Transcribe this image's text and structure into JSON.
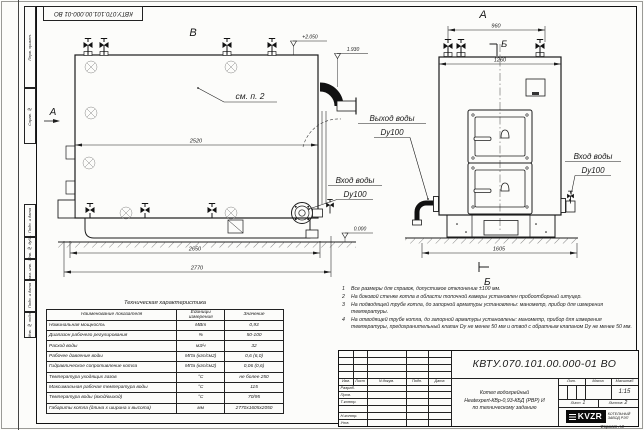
{
  "sheet": {
    "top_stamp": "КВТУ.070.101.00.000-01 ВО",
    "format_label": "Формат А3",
    "side_stamps": [
      "Перв. примен.",
      "Справ. №",
      "Подп. и дата",
      "Инв. № дубл.",
      "Взам. инв. №",
      "Подп. и дата",
      "Инв. № подл."
    ]
  },
  "drawing": {
    "side_view": {
      "label": "В",
      "direction_label": "А",
      "note_ref": "см. п. 2",
      "dim_body": "2520",
      "dim_base": "2650",
      "dim_total": "2770",
      "level_top": "+2.050",
      "level_chimney": "1.930",
      "level_ground": "0.000",
      "inlet_label": "Вход воды",
      "inlet_dn": "Dy100"
    },
    "front_view": {
      "label": "А",
      "section_label": "Б",
      "dim_valves": "960",
      "dim_width": "1260",
      "dim_base": "1605",
      "outlet_label": "Выход воды",
      "outlet_dn": "Dy100",
      "inlet_label": "Вход воды",
      "inlet_dn": "Dy100"
    }
  },
  "notes": {
    "items": [
      {
        "num": "1",
        "text": "Все размеры для справок, допустимое отклонение ±100 мм."
      },
      {
        "num": "2",
        "text": "На боковой стенке котла в области топочной камеры установлен пробоотборный штуцер."
      },
      {
        "num": "3",
        "text": "На подводящей трубе котла, до запорной арматуры установлены: манометр, прибор для измерения температуры."
      },
      {
        "num": "4",
        "text": "На отводящей трубе котла, до запорной арматуры установлены: манометр, прибор для измерения температуры, предохранительный клапан Dу не менее 50 мм и отвод с обратным клапаном Dу не менее 50 мм."
      }
    ]
  },
  "spec_table": {
    "title": "Техническая характеристика",
    "headers": [
      "Наименование показателя",
      "Единицы измерения",
      "Значение"
    ],
    "rows": [
      [
        "Номинальная мощность",
        "МВт",
        "0,93"
      ],
      [
        "Диапазон рабочего регулирования",
        "%",
        "50-100"
      ],
      [
        "Расход воды",
        "м3/ч",
        "32"
      ],
      [
        "Рабочее давление воды",
        "МПа (кгс/см2)",
        "0,6 (6,0)"
      ],
      [
        "Гидравлическое сопротивление котла",
        "МПа (кгс/см2)",
        "0,06 (0,6)"
      ],
      [
        "Температура уходящих газов",
        "°С",
        "не более 250"
      ],
      [
        "Максимальная рабочая температура воды",
        "°С",
        "115"
      ],
      [
        "Температура воды (вход/выход)",
        "°С",
        "70/95"
      ],
      [
        "Габариты котла (длина х ширина х высота)",
        "мм",
        "2770х1605х2050"
      ]
    ]
  },
  "title_block": {
    "designation": "КВТУ.070.101.00.000-01 ВО",
    "name_line1": "Котел водогрейный",
    "name_line2": "Heatexpert-КВр-0,93-КБД (РВР) И",
    "name_line3": "по техническому заданию",
    "header_cols": [
      "Изм.",
      "Лист",
      "N докум.",
      "Подп.",
      "Дата"
    ],
    "sign_rows": [
      "Разраб.",
      "Пров.",
      "Т.контр.",
      "",
      "Н.контр.",
      "Утв."
    ],
    "lit_label": "Лит.",
    "mass_label": "Масса",
    "scale_label": "Масштаб",
    "scale_value": "1:15",
    "sheet_label": "Лист",
    "sheet_value": "1",
    "sheets_label": "Листов",
    "sheets_value": "2",
    "logo_text": "KVZR",
    "company_line1": "КОТЕЛЬНЫЙ",
    "company_line2": "ЗАВОД РЭП"
  }
}
